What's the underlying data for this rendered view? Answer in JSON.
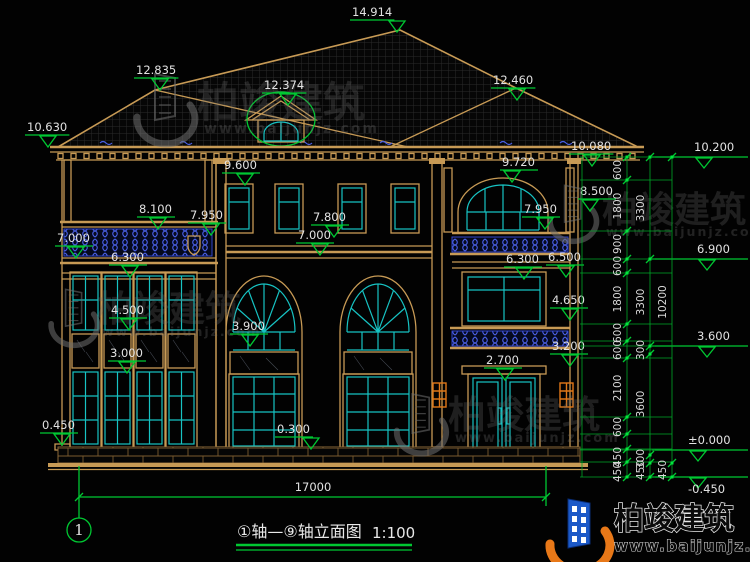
{
  "drawing": {
    "axis_title": "①轴—⑨轴立面图",
    "scale": "1:100",
    "axis_bubble": "1",
    "overall_width": "17000"
  },
  "brand": {
    "name": "柏竣建筑",
    "url": "www.baijunjz.com"
  },
  "colors": {
    "background": "#020202",
    "wall_tan": "#C79A55",
    "glazing_cyan": "#17C3C3",
    "dimension_green": "#00C832",
    "baluster_blue": "#4A60E8",
    "accent_orange": "#E07818",
    "text_white": "#E2E2E2"
  },
  "elevation_markers": [
    {
      "t": "14.914",
      "x": 352,
      "y": 16,
      "cx": 397
    },
    {
      "t": "12.835",
      "x": 136,
      "y": 74,
      "cx": 160
    },
    {
      "t": "12.374",
      "x": 264,
      "y": 89,
      "cx": 288
    },
    {
      "t": "12.460",
      "x": 493,
      "y": 84,
      "cx": 517
    },
    {
      "t": "10.630",
      "x": 27,
      "y": 131,
      "cx": 48
    },
    {
      "t": "10.080",
      "x": 571,
      "y": 150,
      "cx": 592
    },
    {
      "t": "9.600",
      "x": 224,
      "y": 169,
      "cx": 245
    },
    {
      "t": "9.720",
      "x": 502,
      "y": 166,
      "cx": 512
    },
    {
      "t": "8.500",
      "x": 580,
      "y": 195,
      "cx": 590
    },
    {
      "t": "8.100",
      "x": 139,
      "y": 213,
      "cx": 158
    },
    {
      "t": "7.950",
      "x": 190,
      "y": 219,
      "cx": 211
    },
    {
      "t": "7.950",
      "x": 524,
      "y": 213,
      "cx": 545
    },
    {
      "t": "7.800",
      "x": 313,
      "y": 221,
      "cx": 334
    },
    {
      "t": "7.000",
      "x": 57,
      "y": 242,
      "cx": 76
    },
    {
      "t": "7.000",
      "x": 298,
      "y": 239,
      "cx": 320
    },
    {
      "t": "6.500",
      "x": 548,
      "y": 261,
      "cx": 566
    },
    {
      "t": "6.300",
      "x": 111,
      "y": 261,
      "cx": 130
    },
    {
      "t": "6.300",
      "x": 506,
      "y": 263,
      "cx": 524
    },
    {
      "t": "4.500",
      "x": 111,
      "y": 314,
      "cx": 129
    },
    {
      "t": "4.650",
      "x": 552,
      "y": 304,
      "cx": 570
    },
    {
      "t": "3.900",
      "x": 232,
      "y": 330,
      "cx": 250
    },
    {
      "t": "3.200",
      "x": 552,
      "y": 350,
      "cx": 570
    },
    {
      "t": "3.000",
      "x": 110,
      "y": 357,
      "cx": 127
    },
    {
      "t": "2.700",
      "x": 486,
      "y": 364,
      "cx": 505
    },
    {
      "t": "0.450",
      "x": 42,
      "y": 429,
      "cx": 62
    },
    {
      "t": "0.300",
      "x": 277,
      "y": 433,
      "cx": 311
    }
  ],
  "right_levels": [
    {
      "t": "10.200",
      "x": 694,
      "y": 151,
      "ly": 157
    },
    {
      "t": "6.900",
      "x": 697,
      "y": 253,
      "ly": 259
    },
    {
      "t": "3.600",
      "x": 697,
      "y": 340,
      "ly": 346
    },
    {
      "t": "±0.000",
      "x": 688,
      "y": 444,
      "ly": 450
    },
    {
      "t": "-0.450",
      "x": 688,
      "y": 493,
      "ly": 477
    }
  ],
  "dim_chains": {
    "lines": [
      {
        "x": 627,
        "y1": 157,
        "y2": 477
      },
      {
        "x": 650,
        "y1": 157,
        "y2": 477
      },
      {
        "x": 672,
        "y1": 157,
        "y2": 477
      },
      {
        "x": 582,
        "y1": 157,
        "y2": 477
      }
    ],
    "labels": [
      {
        "t": "600",
        "x": 621,
        "y": 170
      },
      {
        "t": "1800",
        "x": 621,
        "y": 206
      },
      {
        "t": "900",
        "x": 621,
        "y": 244
      },
      {
        "t": "600",
        "x": 621,
        "y": 266
      },
      {
        "t": "1800",
        "x": 621,
        "y": 299
      },
      {
        "t": "600",
        "x": 621,
        "y": 333
      },
      {
        "t": "600",
        "x": 621,
        "y": 350
      },
      {
        "t": "2100",
        "x": 621,
        "y": 388
      },
      {
        "t": "600",
        "x": 621,
        "y": 427
      },
      {
        "t": "450",
        "x": 621,
        "y": 457
      },
      {
        "t": "450",
        "x": 621,
        "y": 472
      },
      {
        "t": "3300",
        "x": 644,
        "y": 208
      },
      {
        "t": "3300",
        "x": 644,
        "y": 302
      },
      {
        "t": "300",
        "x": 644,
        "y": 350
      },
      {
        "t": "3600",
        "x": 644,
        "y": 404
      },
      {
        "t": "300",
        "x": 644,
        "y": 459
      },
      {
        "t": "450",
        "x": 644,
        "y": 470
      },
      {
        "t": "10200",
        "x": 666,
        "y": 302
      },
      {
        "t": "450",
        "x": 666,
        "y": 470
      }
    ],
    "ticks": [
      {
        "x": 627,
        "ys": [
          157,
          180,
          231,
          259,
          273,
          324,
          341,
          358,
          417,
          434,
          449,
          462,
          477
        ]
      },
      {
        "x": 650,
        "ys": [
          157,
          259,
          346,
          354,
          455,
          463,
          477
        ]
      },
      {
        "x": 672,
        "ys": [
          157,
          463,
          477
        ]
      }
    ],
    "connectors": [
      {
        "y": 180,
        "x1": 580,
        "x2": 672
      },
      {
        "y": 231,
        "x1": 580,
        "x2": 672
      },
      {
        "y": 273,
        "x1": 580,
        "x2": 672
      },
      {
        "y": 324,
        "x1": 580,
        "x2": 672
      },
      {
        "y": 341,
        "x1": 580,
        "x2": 672
      },
      {
        "y": 358,
        "x1": 580,
        "x2": 672
      },
      {
        "y": 417,
        "x1": 580,
        "x2": 672
      },
      {
        "y": 434,
        "x1": 580,
        "x2": 672
      },
      {
        "y": 449,
        "x1": 580,
        "x2": 672
      },
      {
        "y": 462,
        "x1": 580,
        "x2": 672
      },
      {
        "y": 157,
        "x1": 580,
        "x2": 655
      },
      {
        "y": 259,
        "x1": 580,
        "x2": 655
      },
      {
        "y": 346,
        "x1": 580,
        "x2": 655
      },
      {
        "y": 450,
        "x1": 580,
        "x2": 655
      },
      {
        "y": 477,
        "x1": 580,
        "x2": 655
      }
    ]
  },
  "bottom_dim": {
    "t": "17000",
    "x": 313,
    "y": 491,
    "lineY": 497,
    "x1": 79,
    "x2": 546
  },
  "watermarks": [
    {
      "gx": 163,
      "gy": 101,
      "gs": 1.0,
      "tx": 197,
      "ty": 117,
      "ts": 42,
      "ux": 204,
      "uy": 133,
      "us": 14
    },
    {
      "gx": 571,
      "gy": 207,
      "gs": 0.8,
      "tx": 602,
      "ty": 222,
      "ts": 36,
      "ux": 606,
      "uy": 236,
      "us": 12.5
    },
    {
      "gx": 72,
      "gy": 311,
      "gs": 0.8,
      "tx": 97,
      "ty": 321,
      "ts": 36,
      "ux": 102,
      "uy": 336,
      "us": 12.5
    },
    {
      "gx": 419,
      "gy": 417,
      "gs": 0.85,
      "tx": 448,
      "ty": 428,
      "ts": 38,
      "ux": 455,
      "uy": 442,
      "us": 13
    }
  ]
}
